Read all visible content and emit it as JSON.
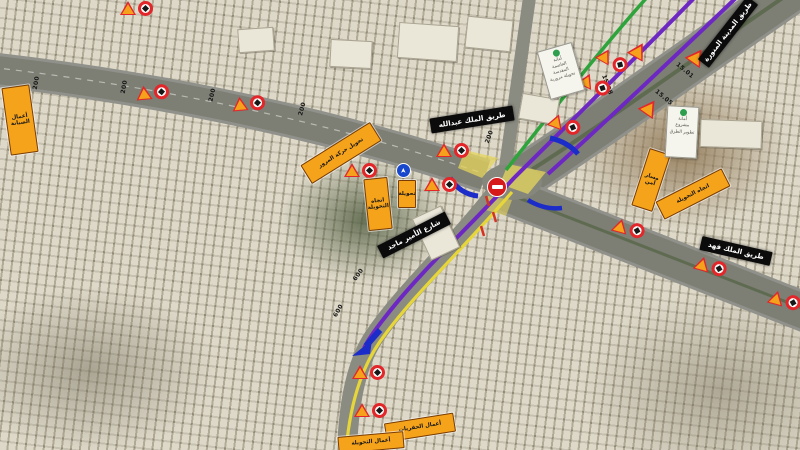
{
  "map": {
    "colors": {
      "route_purple": "#6d28c4",
      "route_yellow": "#e6d63a",
      "route_green": "#2fa43c",
      "barrier_blue": "#1b2cc8",
      "sign_orange": "#f5a11b",
      "sign_red": "#e2262a"
    },
    "road_labels": [
      {
        "t": "200",
        "x": 30,
        "y": 80,
        "rot": -80
      },
      {
        "t": "200",
        "x": 118,
        "y": 84,
        "rot": -80
      },
      {
        "t": "200",
        "x": 206,
        "y": 92,
        "rot": -78
      },
      {
        "t": "200",
        "x": 296,
        "y": 106,
        "rot": -75
      },
      {
        "t": "200",
        "x": 483,
        "y": 134,
        "rot": -70
      },
      {
        "t": "600",
        "x": 332,
        "y": 308,
        "rot": -60
      },
      {
        "t": "600",
        "x": 352,
        "y": 272,
        "rot": -55
      },
      {
        "t": "15.01",
        "x": 674,
        "y": 68,
        "rot": 40
      },
      {
        "t": "15.05",
        "x": 653,
        "y": 95,
        "rot": 40
      },
      {
        "t": "15.08",
        "x": 596,
        "y": 82,
        "rot": 70
      }
    ],
    "warning_pairs": [
      {
        "x": 120,
        "y": 0,
        "rot": 0
      },
      {
        "x": 136,
        "y": 84,
        "rot": -5
      },
      {
        "x": 232,
        "y": 95,
        "rot": -5
      },
      {
        "x": 344,
        "y": 162,
        "rot": 0
      },
      {
        "x": 424,
        "y": 176,
        "rot": 0
      },
      {
        "x": 436,
        "y": 142,
        "rot": 0
      },
      {
        "x": 548,
        "y": 116,
        "rot": 20
      },
      {
        "x": 578,
        "y": 76,
        "rot": 25
      },
      {
        "x": 596,
        "y": 52,
        "rot": 30
      },
      {
        "x": 612,
        "y": 220,
        "rot": 15
      },
      {
        "x": 694,
        "y": 258,
        "rot": 15
      },
      {
        "x": 768,
        "y": 292,
        "rot": 15
      },
      {
        "x": 352,
        "y": 364,
        "rot": 0
      },
      {
        "x": 354,
        "y": 402,
        "rot": 0
      }
    ],
    "warning_triangles": [
      {
        "x": 630,
        "y": 42,
        "rot": 30
      },
      {
        "x": 688,
        "y": 48,
        "rot": 35
      },
      {
        "x": 641,
        "y": 99,
        "rot": 35
      }
    ],
    "orange_signs": [
      {
        "x": 6,
        "y": 86,
        "w": 26,
        "h": 66,
        "rot": -8,
        "l1": "أعمال",
        "l2": "الصيانة"
      },
      {
        "x": 300,
        "y": 142,
        "w": 80,
        "h": 20,
        "rot": -32,
        "l1": "تحويل حركة المرور",
        "l2": ""
      },
      {
        "x": 366,
        "y": 178,
        "w": 22,
        "h": 50,
        "rot": -6,
        "l1": "اتجاه",
        "l2": "التحويلة"
      },
      {
        "x": 398,
        "y": 180,
        "w": 16,
        "h": 26,
        "rot": 0,
        "l1": "تحويلة",
        "l2": ""
      },
      {
        "x": 640,
        "y": 150,
        "w": 20,
        "h": 58,
        "rot": 18,
        "l1": "مسار",
        "l2": "آمن"
      },
      {
        "x": 656,
        "y": 184,
        "w": 72,
        "h": 18,
        "rot": -27,
        "l1": "اتجاه التحويلة",
        "l2": ""
      },
      {
        "x": 385,
        "y": 418,
        "w": 68,
        "h": 17,
        "rot": -9,
        "l1": "أعمال الحفريات",
        "l2": ""
      },
      {
        "x": 338,
        "y": 434,
        "w": 64,
        "h": 15,
        "rot": -5,
        "l1": "أعمال التحويلة",
        "l2": ""
      }
    ],
    "street_banners": [
      {
        "x": 430,
        "y": 112,
        "w": 84,
        "h": 15,
        "rot": -9,
        "text": "طريق الملك عبدالله"
      },
      {
        "x": 688,
        "y": 25,
        "w": 80,
        "h": 14,
        "rot": -52,
        "text": "طريق المدينة المنورة"
      },
      {
        "x": 376,
        "y": 228,
        "w": 76,
        "h": 14,
        "rot": -27,
        "text": "شارع الأمير ماجد"
      },
      {
        "x": 700,
        "y": 244,
        "w": 72,
        "h": 14,
        "rot": 13,
        "text": "طريق الملك فهد"
      }
    ],
    "info_boards": [
      {
        "x": 543,
        "y": 46,
        "w": 36,
        "h": 50,
        "rot": -16,
        "l1": "أمانة",
        "l2": "العاصمة المقدسة",
        "l3": "تحويلة مرورية"
      },
      {
        "x": 666,
        "y": 106,
        "w": 32,
        "h": 52,
        "rot": 3,
        "l1": "أمانة",
        "l2": "مشروع",
        "l3": "تطوير الطرق"
      }
    ],
    "no_entry_sign": {
      "x": 487,
      "y": 177
    },
    "mandatory_sign": {
      "x": 396,
      "y": 163
    }
  }
}
